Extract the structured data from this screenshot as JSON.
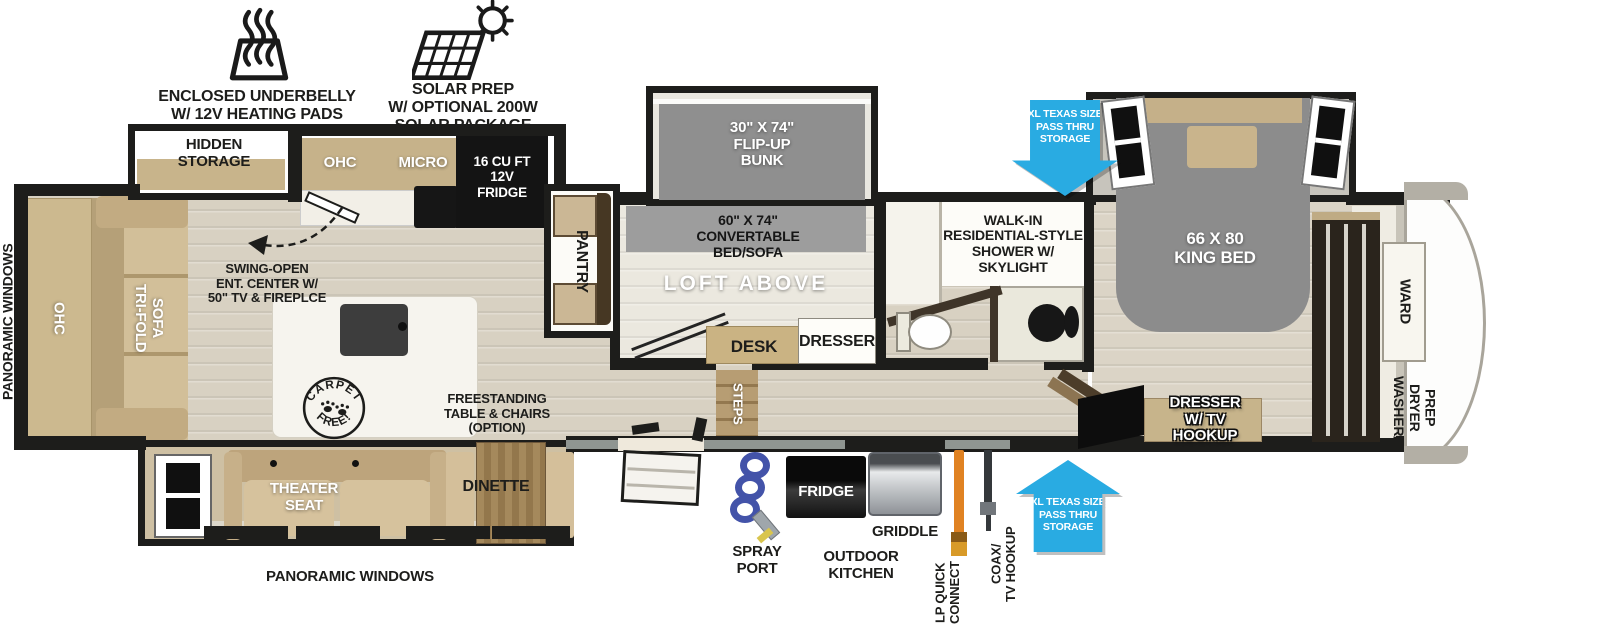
{
  "callouts": {
    "underbelly": "ENCLOSED UNDERBELLY\nW/ 12V HEATING PADS",
    "solar": "SOLAR PREP\nW/ OPTIONAL 200W\nSOLAR PACKAGE"
  },
  "exterior": {
    "panoramic_left": "PANORAMIC WINDOWS",
    "panoramic_bottom": "PANORAMIC WINDOWS",
    "pass_thru_top": "XL TEXAS SIZE\nPASS THRU\nSTORAGE",
    "pass_thru_bottom": "XL TEXAS SIZE\nPASS THRU\nSTORAGE",
    "spray_port": "SPRAY\nPORT",
    "outdoor_fridge": "FRIDGE",
    "griddle": "GRIDDLE",
    "outdoor_kitchen": "OUTDOOR\nKITCHEN",
    "lp_quick_connect": "LP QUICK\nCONNECT",
    "coax_tv_hookup": "COAX/\nTV HOOKUP"
  },
  "living_room": {
    "hidden_storage": "HIDDEN\nSTORAGE",
    "ohc": "OHC",
    "tri_fold_sofa": "TRI-FOLD\nSOFA",
    "swing_open": "SWING-OPEN\nENT. CENTER W/\n50\" TV & FIREPLCE",
    "carpet_stamp_top": "CARPET",
    "carpet_stamp_bottom": "FREE!",
    "theater_seat": "THEATER\nSEAT",
    "dinette": "DINETTE",
    "freestanding_option": "FREESTANDING\nTABLE & CHAIRS\n(OPTION)"
  },
  "kitchen": {
    "ohc": "OHC",
    "micro": "MICRO",
    "fridge_12v": "16 CU FT\n12V\nFRIDGE",
    "pantry": "PANTRY",
    "steps": "STEPS"
  },
  "bunk_room": {
    "flip_up_bunk": "30\" X 74\"\nFLIP-UP\nBUNK",
    "convertable_bed_sofa": "60\" X 74\"\nCONVERTABLE\nBED/SOFA",
    "loft_above": "LOFT ABOVE",
    "desk": "DESK",
    "dresser": "DRESSER"
  },
  "bathroom": {
    "shower": "WALK-IN\nRESIDENTIAL-STYLE\nSHOWER W/\nSKYLIGHT"
  },
  "bedroom": {
    "king_bed": "66 X 80\nKING BED",
    "dresser_tv": "DRESSER\nW/ TV\nHOOKUP",
    "ward": "WARD",
    "washer_dryer_prep": "WASHER/\nDRYER\nPREP"
  },
  "icons": {
    "heating_pads_icon": "trapezoid heating pad with heat waves",
    "solar_panel_icon": "solar panel grid with sun",
    "pass_thru_arrow_icon": "block arrow",
    "swing_arrow_icon": "dashed curved arrow",
    "carpet_free_stamp_icon": "circular stamp with paw prints"
  },
  "colors": {
    "accent_blue": "#29abe2",
    "wall_black": "#1d1d1b",
    "floor_tan": "#d8d1c2",
    "furniture_tan": "#cdb88f",
    "bed_gray": "#8c8c8c",
    "lp_hose_orange": "#e08222",
    "spray_hose_blue": "#4252a8"
  }
}
